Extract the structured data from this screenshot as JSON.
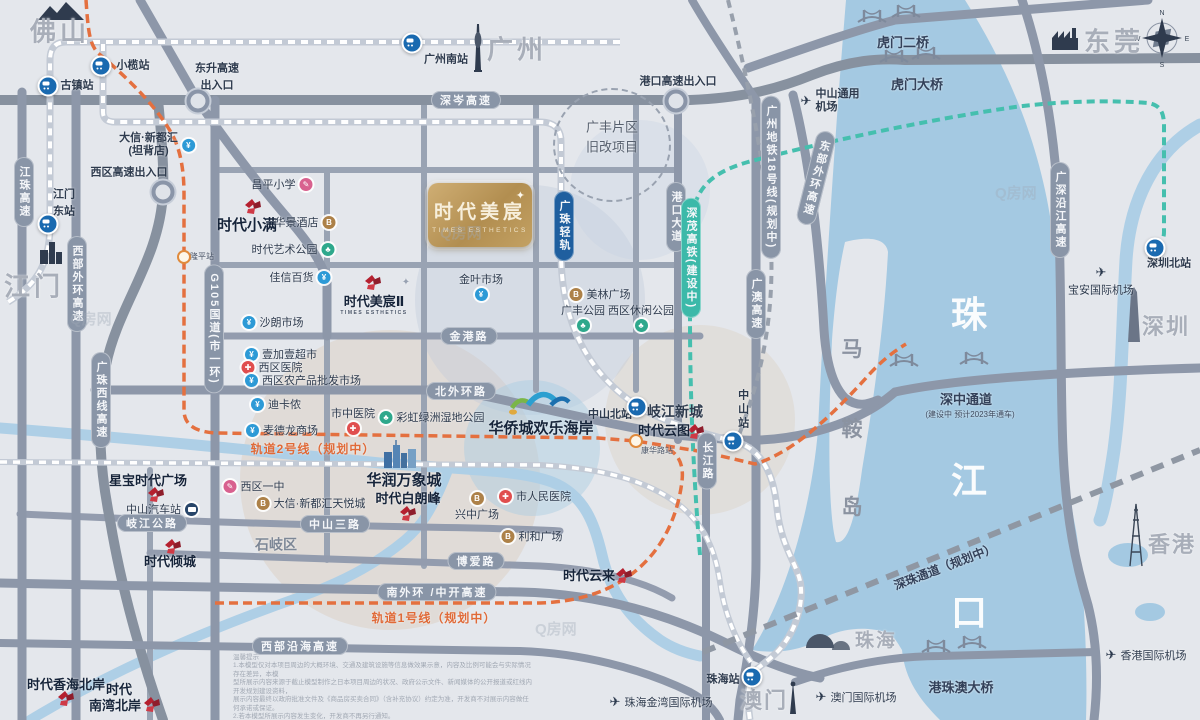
{
  "brand": {
    "name": "时代美宸",
    "en": "TIMES ESTHETICS",
    "sparkle": "✦"
  },
  "cities": [
    {
      "label": "佛山"
    },
    {
      "label": "广州"
    },
    {
      "label": "江门"
    },
    {
      "label": "东莞"
    },
    {
      "label": "深圳"
    },
    {
      "label": "香港"
    },
    {
      "label": "珠海"
    },
    {
      "label": "澳门"
    }
  ],
  "sea": {
    "char1": "珠",
    "char2": "江",
    "char3": "口"
  },
  "island": {
    "char1": "马",
    "char2": "鞍",
    "char3": "岛"
  },
  "stations": [
    {
      "label": "小榄站"
    },
    {
      "label": "古镇站"
    },
    {
      "l1": "江门",
      "l2": "东站"
    },
    {
      "label": "广州南站"
    },
    {
      "label": "中山北站"
    },
    {
      "label": "中山站"
    },
    {
      "label": "珠海站"
    },
    {
      "label": "深圳北站"
    },
    {
      "label": "隆平站"
    },
    {
      "label": "康华路站"
    }
  ],
  "roads": [
    {
      "label": "深岑高速"
    },
    {
      "label": "金港路"
    },
    {
      "label": "北外环路"
    },
    {
      "label": "中山三路"
    },
    {
      "label": "岐江公路"
    },
    {
      "label": "博爱路"
    },
    {
      "label": "南外环 /中开高速"
    },
    {
      "label": "西部沿海高速"
    },
    {
      "label": "江珠高速"
    },
    {
      "label": "西部外环高速"
    },
    {
      "label": "广珠西线高速"
    },
    {
      "label": "G105国道(市一环)"
    },
    {
      "label": "港口大道"
    },
    {
      "label": "广澳高速"
    },
    {
      "label": "长江路"
    },
    {
      "label": "广深沿江高速"
    },
    {
      "label": "东部外环高速"
    }
  ],
  "rails": [
    {
      "label": "广珠轻轨"
    },
    {
      "label": "深茂高铁(建设中)"
    },
    {
      "label": "广州地铁18号线(规划中)"
    }
  ],
  "metro": [
    {
      "label": "轨道2号线（规划中）"
    },
    {
      "label": "轨道1号线（规划中）"
    }
  ],
  "bridges": [
    {
      "label": "虎门二桥"
    },
    {
      "label": "虎门大桥"
    },
    {
      "label": "深中通道",
      "sub": "(建设中  预计2023年通车)"
    },
    {
      "label": "港珠澳大桥"
    },
    {
      "label": "深珠通道（规划中）"
    }
  ],
  "airports": [
    {
      "l1": "中山通用",
      "l2": "机场"
    },
    {
      "label": "宝安国际机场"
    },
    {
      "label": "珠海金湾国际机场"
    },
    {
      "label": "澳门国际机场"
    },
    {
      "label": "香港国际机场"
    }
  ],
  "interchanges": [
    {
      "l1": "东升高速",
      "l2": "出入口"
    },
    {
      "label": "西区高速出入口"
    },
    {
      "label": "港口高速出入口"
    }
  ],
  "areas": [
    {
      "l1": "广丰片区",
      "l2": "旧改项目"
    },
    {
      "label": "石岐区"
    },
    {
      "label": "岐江新城"
    }
  ],
  "projects": [
    {
      "label": "时代小满"
    },
    {
      "label": "时代美宸Ⅱ",
      "en": "TIMES ESTHETICS"
    },
    {
      "label": "时代白朗峰"
    },
    {
      "label": "星宝时代广场"
    },
    {
      "label": "时代倾城"
    },
    {
      "label": "时代云图"
    },
    {
      "label": "时代云来"
    },
    {
      "label": "时代香海北岸"
    },
    {
      "l1": "时代",
      "l2": "南湾北岸"
    }
  ],
  "complexes": [
    {
      "label": "华润万象城"
    },
    {
      "label": "华侨城欢乐海岸"
    }
  ],
  "pois": [
    {
      "label": "昌平小学"
    },
    {
      "label": "华景酒店"
    },
    {
      "label": "时代艺术公园"
    },
    {
      "label": "佳信百货"
    },
    {
      "label": "沙朗市场"
    },
    {
      "label": "壹加壹超市"
    },
    {
      "label": "西区医院"
    },
    {
      "label": "西区农产品批发市场"
    },
    {
      "label": "迪卡侬"
    },
    {
      "label": "麦德龙商场"
    },
    {
      "label": "市中医院"
    },
    {
      "label": "彩虹绿洲湿地公园"
    },
    {
      "label": "金叶市场"
    },
    {
      "label": "美林广场"
    },
    {
      "label": "广丰公园"
    },
    {
      "label": "西区休闲公园"
    },
    {
      "label": "西区一中"
    },
    {
      "label": "大信·新都汇天悦城"
    },
    {
      "label": "市人民医院"
    },
    {
      "label": "兴中广场"
    },
    {
      "label": "利和广场"
    },
    {
      "l1": "大信·新都汇",
      "l2": "(坦背店)"
    },
    {
      "label": "中山汽车站"
    }
  ],
  "icons": {
    "hospital": "✚",
    "park": "♣",
    "school": "✎",
    "shop": "¥",
    "mall": "B"
  },
  "compass": {
    "n": "N",
    "e": "E",
    "s": "S",
    "w": "W"
  },
  "watermark": "Q房网",
  "disclaimer": {
    "title": "温馨提示",
    "line1": "1.本模型仅对本项目周边的大概环境、交通及建筑设施等信息做效果示意，内容及比例可能会与实际情况存在差异，本模",
    "line2": "型所展示内容来源于截止模型制作之日本项目周边的状况、政府公示文件、新闻媒体的公开报道或红线内开发规划建设资料，",
    "line3": "展示内容最终以政府批准文件及《商品房买卖合同》（含补充协议）约定为准，开发商不对展示内容做任何承诺或保证。",
    "line4": "2.若本模型所展示内容发生变化，开发商不再另行通知。",
    "company": "中山市金沙实业股份有限公司",
    "date": "制作日期：2020年8月30日"
  }
}
